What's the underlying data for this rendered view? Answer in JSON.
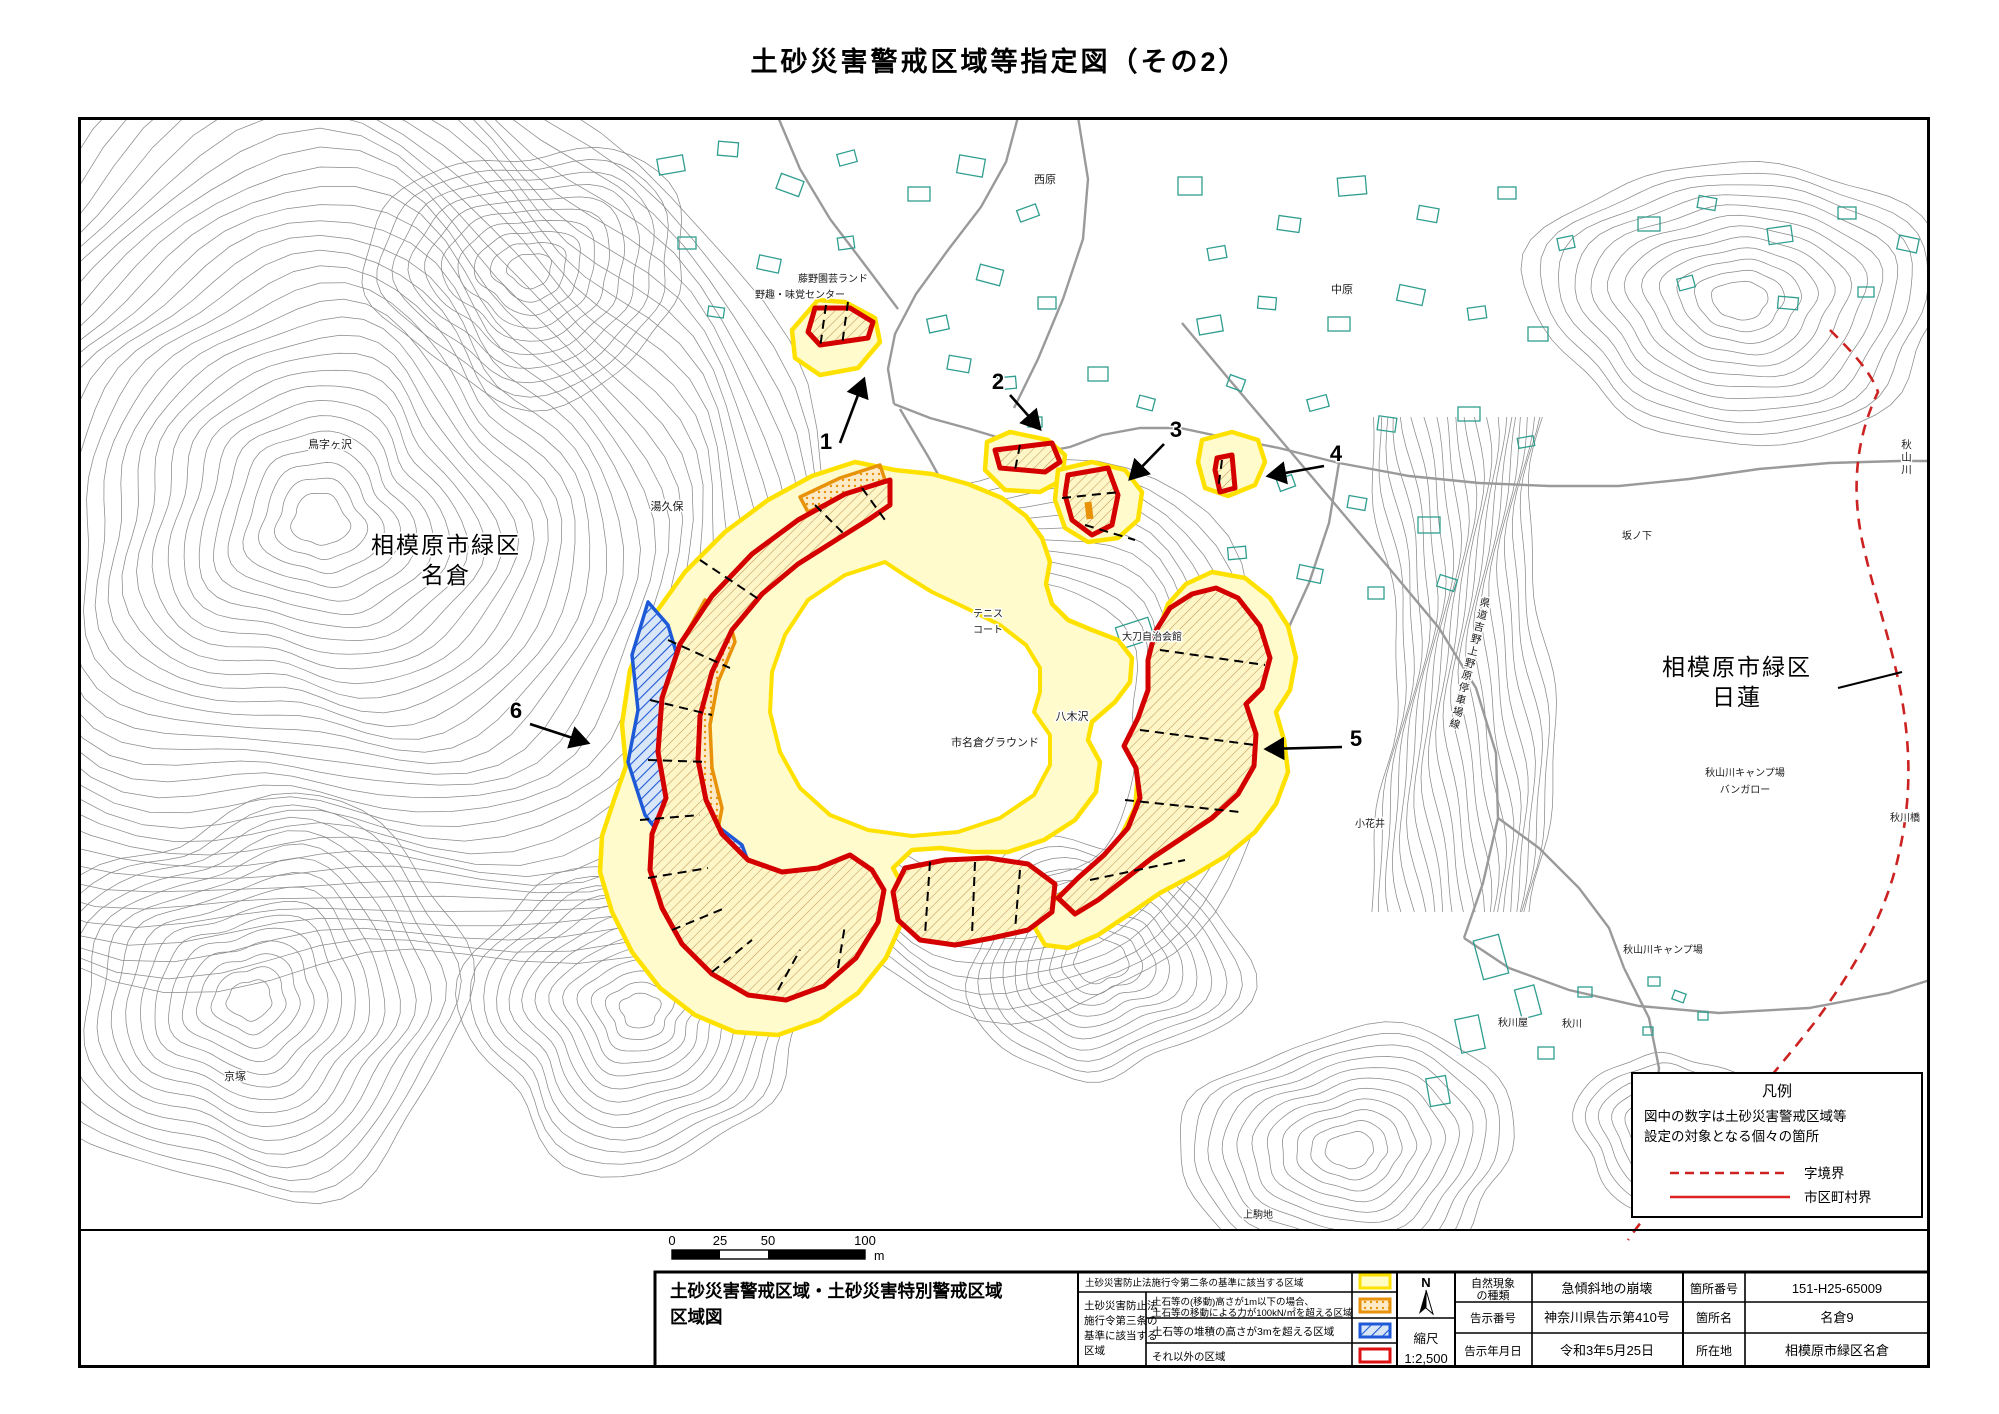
{
  "title": "土砂災害警戒区域等指定図（その2）",
  "map": {
    "place_labels": [
      {
        "id": "torijigasawa",
        "text": "鳥字ヶ沢",
        "x": 252,
        "y": 331,
        "size": 11
      },
      {
        "id": "yukubo",
        "text": "湯久保",
        "x": 589,
        "y": 393,
        "size": 11
      },
      {
        "id": "kyozuka",
        "text": "京塚",
        "x": 157,
        "y": 963,
        "size": 11
      },
      {
        "id": "nishihara",
        "text": "西原",
        "x": 967,
        "y": 66,
        "size": 11
      },
      {
        "id": "nakahara",
        "text": "中原",
        "x": 1264,
        "y": 176,
        "size": 11
      },
      {
        "id": "sakanoshita",
        "text": "坂ノ下",
        "x": 1559,
        "y": 422,
        "size": 10
      },
      {
        "id": "akiyamagawa-camp-1",
        "text": "秋山川キャンプ場",
        "x": 1667,
        "y": 659,
        "size": 10
      },
      {
        "id": "bungalow",
        "text": "バンガロー",
        "x": 1667,
        "y": 676,
        "size": 10
      },
      {
        "id": "akikawabashi",
        "text": "秋川橋",
        "x": 1827,
        "y": 704,
        "size": 10
      },
      {
        "id": "akiyamagawa-camp-2",
        "text": "秋山川キャンプ場",
        "x": 1585,
        "y": 836,
        "size": 10
      },
      {
        "id": "akikawaya",
        "text": "秋川屋",
        "x": 1435,
        "y": 909,
        "size": 10
      },
      {
        "id": "akikawa",
        "text": "秋川",
        "x": 1494,
        "y": 910,
        "size": 10
      },
      {
        "id": "kamikomachi",
        "text": "上駒地",
        "x": 1180,
        "y": 1101,
        "size": 10
      },
      {
        "id": "obanai",
        "text": "小花井",
        "x": 1292,
        "y": 710,
        "size": 10
      },
      {
        "id": "yagisawa",
        "text": "八木沢",
        "x": 994,
        "y": 603,
        "size": 11
      },
      {
        "id": "tachi-jichikaikan",
        "text": "大刀自治会館",
        "x": 1074,
        "y": 523,
        "size": 10
      },
      {
        "id": "ichinagura-ground",
        "text": "市名倉グラウンド",
        "x": 917,
        "y": 629,
        "size": 11
      },
      {
        "id": "tennis-line1",
        "text": "テニス",
        "x": 910,
        "y": 500,
        "size": 10
      },
      {
        "id": "tennis-line2",
        "text": "コート",
        "x": 910,
        "y": 516,
        "size": 10
      },
      {
        "id": "fujino-engei-land",
        "text": "藤野園芸ランド",
        "x": 755,
        "y": 165,
        "size": 10
      },
      {
        "id": "yashu-mikaku-center",
        "text": "野趣・味覚センター",
        "x": 722,
        "y": 181,
        "size": 10
      }
    ],
    "district_labels": [
      {
        "id": "nagura",
        "line1": "相模原市緑区",
        "line2": "名倉",
        "x": 368,
        "y": 436,
        "size": 23
      },
      {
        "id": "nichiren",
        "line1": "相模原市緑区",
        "line2": "日蓮",
        "x": 1659,
        "y": 558,
        "size": 23
      }
    ],
    "vertical_labels": [
      {
        "id": "kendo-yoshino-uenohara",
        "text": "県道吉野上野原停車場線",
        "x": 1408,
        "y": 480,
        "rotate": 14,
        "size": 10.5
      },
      {
        "id": "akiyamagawa-river",
        "text": "秋山川",
        "x": 1828,
        "y": 322,
        "rotate": 0,
        "size": 10.5
      }
    ],
    "zone_numbers": [
      {
        "n": "1",
        "x": 748,
        "y": 332,
        "arrow": [
          762,
          326,
          786,
          262
        ]
      },
      {
        "n": "2",
        "x": 920,
        "y": 272,
        "arrow": [
          932,
          278,
          962,
          312
        ]
      },
      {
        "n": "3",
        "x": 1098,
        "y": 320,
        "arrow": [
          1086,
          327,
          1052,
          362
        ]
      },
      {
        "n": "4",
        "x": 1258,
        "y": 344,
        "arrow": [
          1246,
          349,
          1190,
          359
        ]
      },
      {
        "n": "5",
        "x": 1278,
        "y": 629,
        "arrow": [
          1264,
          630,
          1188,
          632
        ]
      },
      {
        "n": "6",
        "x": 438,
        "y": 601,
        "arrow": [
          452,
          607,
          510,
          626
        ]
      }
    ]
  },
  "legend_box": {
    "title": "凡例",
    "note_line1": "図中の数字は土砂災害警戒区域等",
    "note_line2": "設定の対象となる個々の箇所",
    "items": [
      {
        "label": "字境界",
        "style": "red-dashed"
      },
      {
        "label": "市区町村界",
        "style": "red-solid"
      }
    ]
  },
  "scale_bar": {
    "labels": [
      "0",
      "25",
      "50",
      "100"
    ],
    "unit": "m"
  },
  "table": {
    "title_line1": "土砂災害警戒区域・土砂災害特別警戒区域",
    "title_line2": "区域図",
    "legend_row1_label": "土砂災害防止法施行令第二条の基準に該当する区域",
    "group_lines": [
      "土砂災害防止法",
      "施行令第三条の",
      "基準に該当する",
      "区域"
    ],
    "row2_line1": "土石等の(移動)高さが1m以下の場合、",
    "row2_line2": "土石等の移動による力が100kN/㎡を超える区域",
    "row3_label": "土石等の堆積の高さが3mを超える区域",
    "row4_label": "それ以外の区域",
    "compass_n": "N",
    "scale_label": "縮尺",
    "scale_value": "1:2,500",
    "info_rows": [
      {
        "label": "自然現象",
        "label2": "の種類",
        "value": "急傾斜地の崩壊"
      },
      {
        "label": "告示番号",
        "label2": "",
        "value": "神奈川県告示第410号"
      },
      {
        "label": "告示年月日",
        "label2": "",
        "value": "令和3年5月25日"
      },
      {
        "label": "箇所番号",
        "label2": "",
        "value": "151-H25-65009"
      },
      {
        "label": "箇所名",
        "label2": "",
        "value": "名倉9"
      },
      {
        "label": "所在地",
        "label2": "",
        "value": "相模原市緑区名倉"
      }
    ]
  },
  "colors": {
    "warning_yellow_line": "#FFE100",
    "warning_yellow_fill": "#FFFBCC",
    "special_red": "#D40000",
    "orange": "#E8920A",
    "blue": "#1E5AD7",
    "building_teal": "#2F9E8F",
    "contour_gray": "#8A8A8A",
    "boundary_red": "#CC2222"
  }
}
